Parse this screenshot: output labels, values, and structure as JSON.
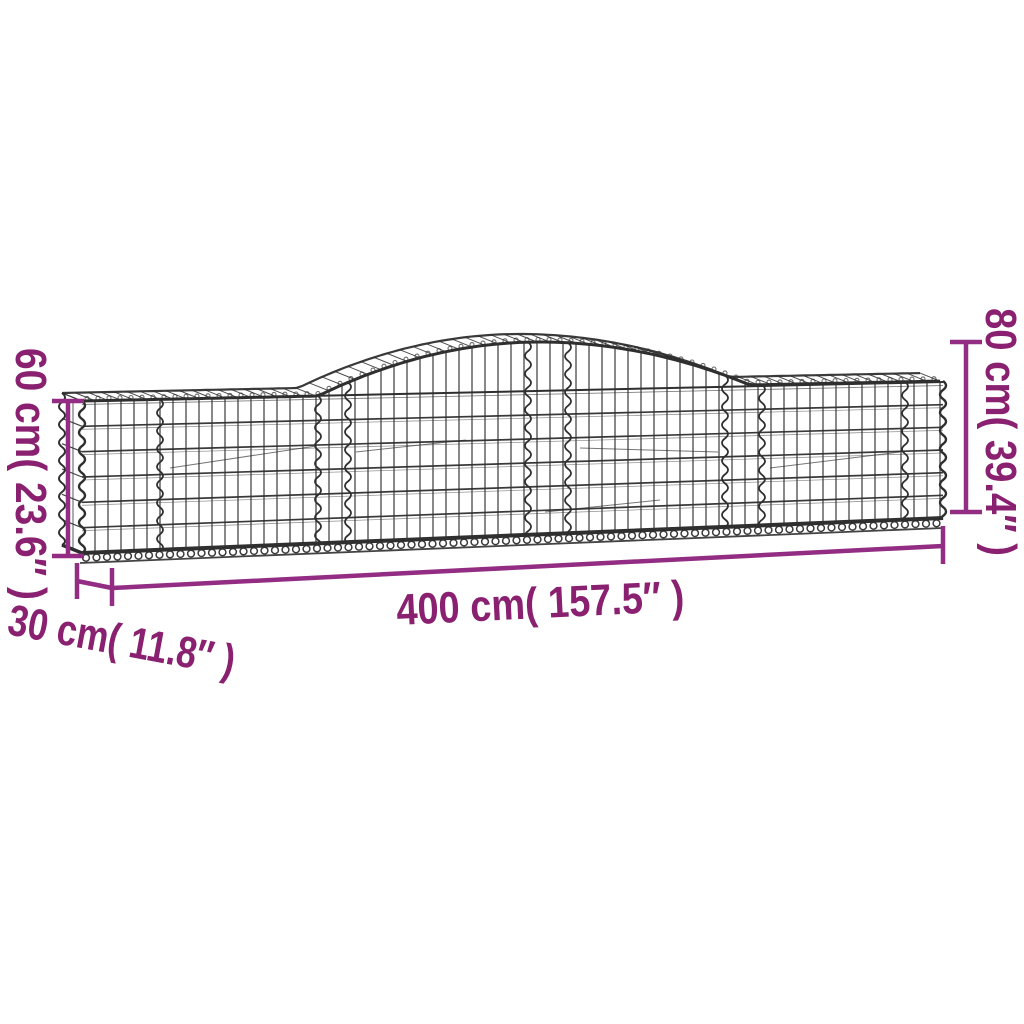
{
  "colors": {
    "background": "#ffffff",
    "wire": "#2f2f2f",
    "dimension_line": "#932d84",
    "dimension_text": "#8a2070"
  },
  "dimensions": {
    "end_height": "60 cm( 23.6″ )",
    "peak_height": "80 cm( 39.4″ )",
    "length": "400 cm( 157.5″ )",
    "depth": "30 cm( 11.8″ )"
  }
}
